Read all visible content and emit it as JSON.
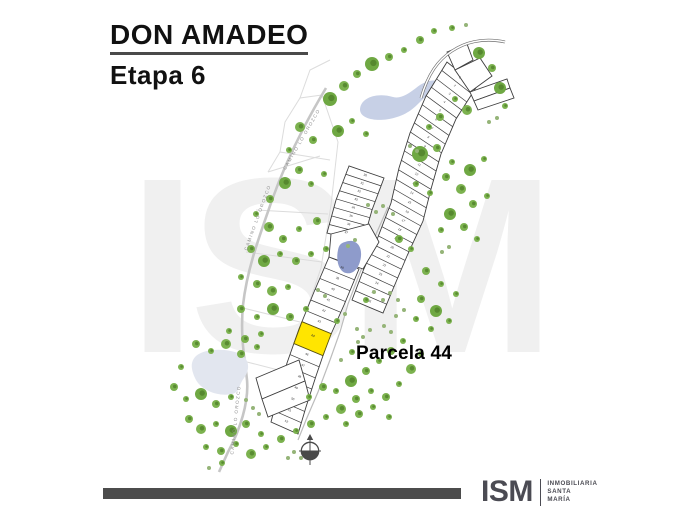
{
  "header": {
    "title": "DON AMADEO",
    "subtitle": "Etapa 6"
  },
  "watermark": "ISM",
  "map": {
    "road_label": "CAMINO LO OROZCO",
    "highlight": {
      "label": "Parcela 44",
      "number": "44",
      "color": "#FFE500"
    },
    "bands": [
      {
        "name": "upper-band",
        "start": 1,
        "count": 26
      },
      {
        "name": "mid-left-band",
        "start": 30,
        "count": 8
      },
      {
        "name": "lower-left-band",
        "start": 38,
        "count": 15,
        "highlight_number": 44
      }
    ],
    "colors": {
      "parcel_fill": "#ffffff",
      "parcel_stroke": "#3d3d3d",
      "road": "#c6c6c6",
      "faint_line": "#dcdcdc",
      "road_text": "#8f8f8f",
      "water_top": "#c7d0e6",
      "water_mid": "#8e9bcb",
      "water_bottom": "#e2e6ef",
      "tree_large": "#6fa843",
      "tree_mid": "#7cb24f",
      "tree_small": "#95b478",
      "tree_core": "#4d7d28",
      "compass": "#4a4a4a",
      "watermark": "#f0f0f0"
    }
  },
  "footer": {
    "logo": "ISM",
    "company_lines": [
      "INMOBILIARIA",
      "SANTA",
      "MARÍA"
    ]
  }
}
